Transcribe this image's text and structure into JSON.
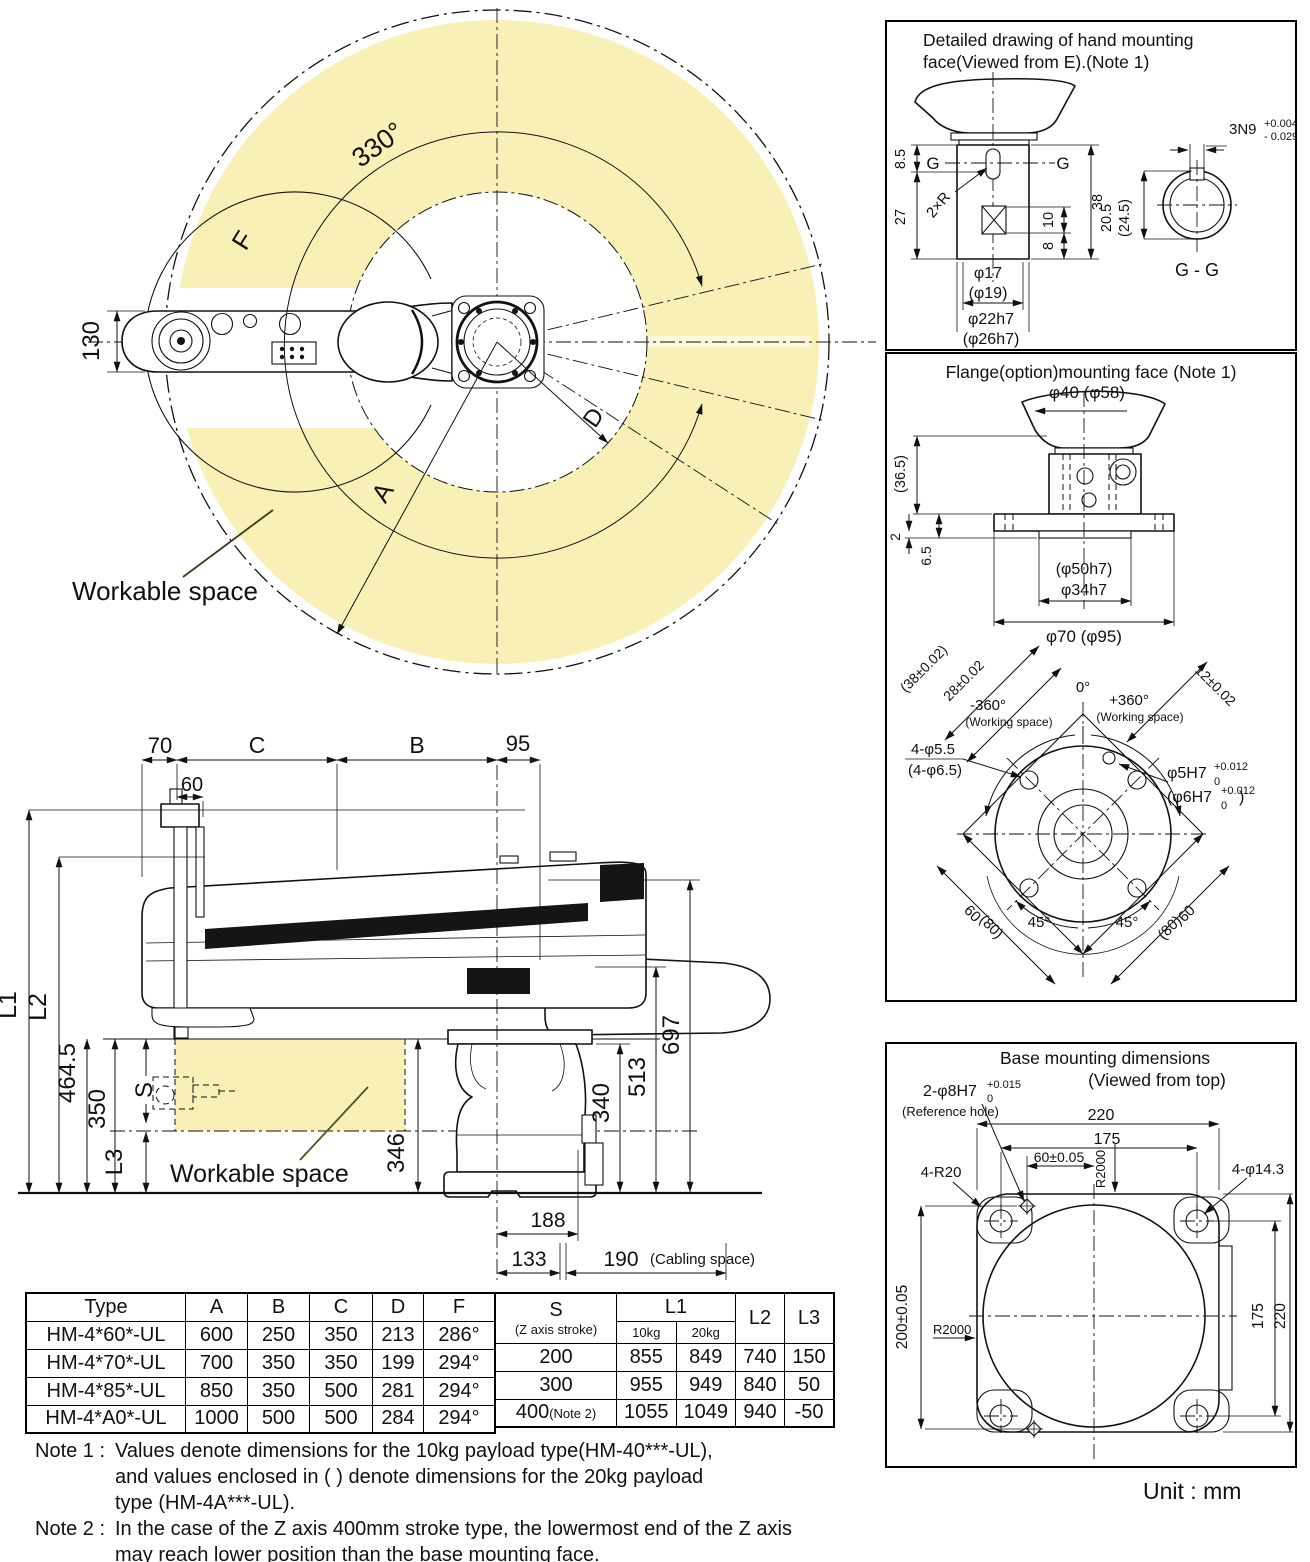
{
  "colors": {
    "workspace_yellow": "#f8f0b6",
    "workspace_pale": "#fcf8dc",
    "label_olive": "#6b6518"
  },
  "unit_label": "Unit : mm",
  "topview": {
    "angle_330": "330°",
    "label_f": "F",
    "label_a": "A",
    "label_d": "D",
    "dim_130": "130",
    "workable_space": "Workable space"
  },
  "sideview": {
    "dim_70": "70",
    "dim_60": "60",
    "dim_c": "C",
    "dim_b": "B",
    "dim_95": "95",
    "dim_l1": "L1",
    "dim_l2": "L2",
    "dim_464_5": "464.5",
    "dim_350": "350",
    "dim_s": "S",
    "dim_l3": "L3",
    "dim_697": "697",
    "dim_513": "513",
    "dim_340": "340",
    "dim_346": "346",
    "dim_188": "188",
    "dim_133": "133",
    "dim_190": "190",
    "cabling_space": "(Cabling space)",
    "workable_space": "Workable space"
  },
  "hand_panel": {
    "title_line1": "Detailed drawing of hand mounting",
    "title_line2": "face(Viewed from E).(Note 1)",
    "dim_8_5": "8.5",
    "g_left": "G",
    "g_right": "G",
    "dim_27": "27",
    "dim_2xr": "2×R",
    "dim_38": "38",
    "dim_10": "10",
    "dim_8": "8",
    "dim_phi17": "φ17",
    "dim_phi19": "(φ19)",
    "dim_phi22h7": "φ22h7",
    "dim_phi26h7": "(φ26h7)",
    "key_label": "3N9",
    "key_tol_top": "+0.004",
    "key_tol_bot": "- 0.029",
    "dim_20_5": "20.5",
    "dim_24_5": "(24.5)",
    "section_label": "G - G"
  },
  "flange_panel": {
    "title": "Flange(option)mounting face (Note 1)",
    "dim_phi40_58": "φ40 (φ58)",
    "dim_36_5": "(36.5)",
    "dim_2": "2",
    "dim_6_5": "6.5",
    "dim_phi50h7": "(φ50h7)",
    "dim_phi34h7": "φ34h7",
    "dim_phi70_95": "φ70 (φ95)",
    "dim_38_002": "(38±0.02)",
    "dim_28_002": "28±0.02",
    "deg_0": "0°",
    "deg_minus360": "-360°",
    "working_space_l": "(Working space)",
    "deg_plus360": "+360°",
    "working_space_r": "(Working space)",
    "dim_12_002": "12±0.02",
    "dim_4_phi55": "4-φ5.5",
    "dim_4_phi65": "(4-φ6.5)",
    "dim_phi5h7": "φ5H7",
    "phi5_tol_top": "+0.012",
    "phi5_tol_bot": "0",
    "dim_phi6h7": "(φ6H7",
    "phi6_tol_top": "+0.012",
    "phi6_tol_bot": "0",
    "phi6_close": ")",
    "dim_60_left": "60",
    "dim_80_left": "(80)",
    "dim_60_right": "60",
    "dim_80_right": "(80)",
    "deg_45_left": "45°",
    "deg_45_right": "45°"
  },
  "base_panel": {
    "title_line1": "Base mounting dimensions",
    "title_line2": "(Viewed from top)",
    "ref_hole_label": "2-φ8H7",
    "ref_hole_tol_top": "+0.015",
    "ref_hole_tol_bot": "0",
    "ref_hole_note": "(Reference hole)",
    "dim_220_top": "220",
    "dim_175_top": "175",
    "dim_60_005": "60±0.05",
    "r2000_top": "R2000",
    "dim_4_r20": "4-R20",
    "dim_4_phi143": "4-φ14.3",
    "dim_200_005": "200±0.05",
    "r2000_left": "R2000",
    "dim_175_right": "175",
    "dim_220_right": "220"
  },
  "dim_table": {
    "headers": [
      "Type",
      "A",
      "B",
      "C",
      "D",
      "F"
    ],
    "rows": [
      [
        "HM-4*60*-UL",
        "600",
        "250",
        "350",
        "213",
        "286°"
      ],
      [
        "HM-4*70*-UL",
        "700",
        "350",
        "350",
        "199",
        "294°"
      ],
      [
        "HM-4*85*-UL",
        "850",
        "350",
        "500",
        "281",
        "294°"
      ],
      [
        "HM-4*A0*-UL",
        "1000",
        "500",
        "500",
        "284",
        "294°"
      ]
    ]
  },
  "stroke_table": {
    "header_s": "S",
    "header_s_sub": "(Z axis stroke)",
    "header_l1": "L1",
    "header_10kg": "10kg",
    "header_20kg": "20kg",
    "header_l2": "L2",
    "header_l3": "L3",
    "rows": [
      {
        "s": "200",
        "s_note": "",
        "l1_10": "855",
        "l1_20": "849",
        "l2": "740",
        "l3": "150"
      },
      {
        "s": "300",
        "s_note": "",
        "l1_10": "955",
        "l1_20": "949",
        "l2": "840",
        "l3": "50"
      },
      {
        "s": "400",
        "s_note": "(Note 2)",
        "l1_10": "1055",
        "l1_20": "1049",
        "l2": "940",
        "l3": "-50"
      }
    ]
  },
  "notes": {
    "note1_label": "Note 1 :",
    "note1_line1": "Values denote dimensions for the 10kg payload type(HM-40***-UL),",
    "note1_line2": "and values enclosed in (  ) denote dimensions for the 20kg payload",
    "note1_line3": "type (HM-4A***-UL).",
    "note2_label": "Note 2 :",
    "note2_line1": "In the case of the Z axis 400mm stroke type, the lowermost end of the Z axis",
    "note2_line2": "may reach lower position than the base mounting face."
  }
}
